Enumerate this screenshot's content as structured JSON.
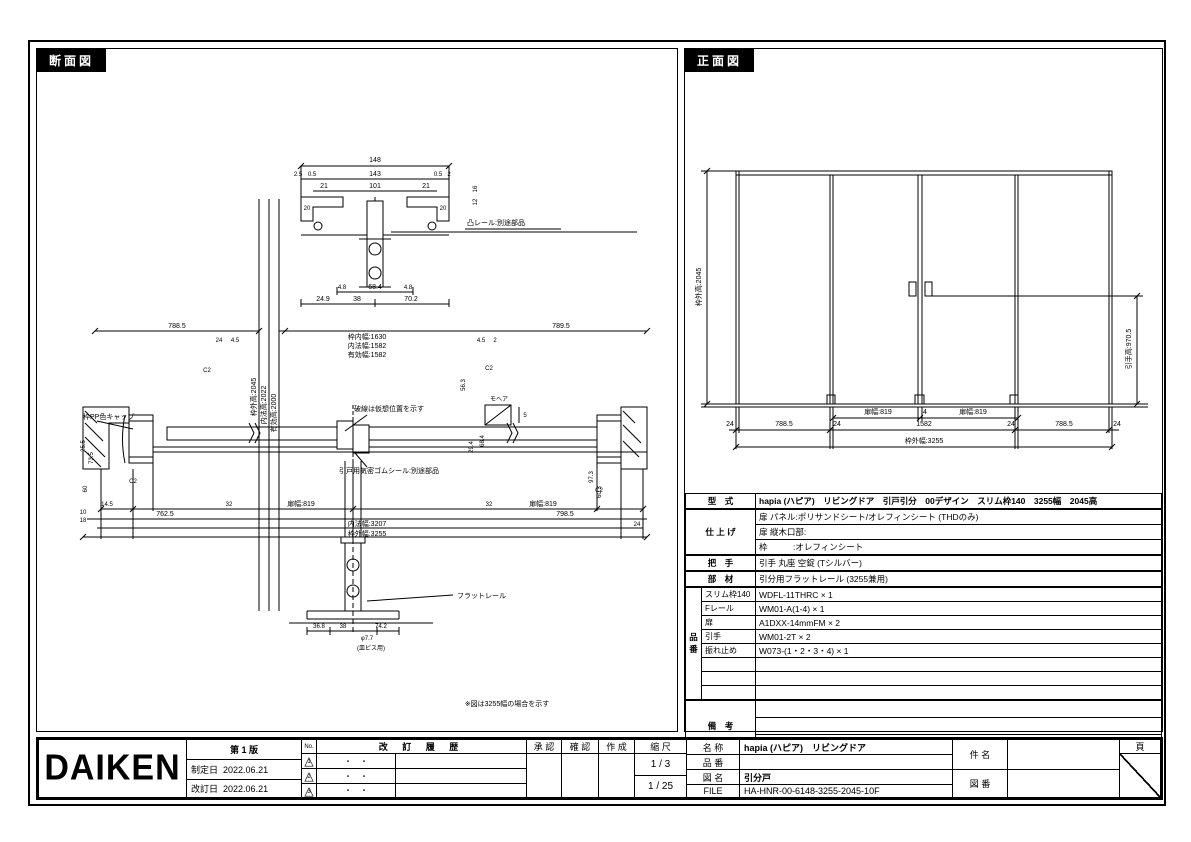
{
  "sheet": {
    "section_title": "断面図",
    "front_title": "正面図"
  },
  "section_view": {
    "texts": [
      {
        "t": "148",
        "x": 338,
        "y": 113
      },
      {
        "t": "2.5",
        "x": 261,
        "y": 127,
        "s": 6
      },
      {
        "t": "0.5",
        "x": 275,
        "y": 127,
        "s": 6
      },
      {
        "t": "143",
        "x": 338,
        "y": 127
      },
      {
        "t": "0.5",
        "x": 401,
        "y": 127,
        "s": 6
      },
      {
        "t": "2",
        "x": 412,
        "y": 127,
        "s": 6
      },
      {
        "t": "21",
        "x": 287,
        "y": 139
      },
      {
        "t": "101",
        "x": 338,
        "y": 139
      },
      {
        "t": "21",
        "x": 389,
        "y": 139
      },
      {
        "t": "20",
        "x": 270,
        "y": 161,
        "s": 6
      },
      {
        "t": "20",
        "x": 406,
        "y": 161,
        "s": 6
      },
      {
        "t": "16",
        "x": 440,
        "y": 140,
        "r": -90,
        "s": 6
      },
      {
        "t": "12",
        "x": 440,
        "y": 153,
        "r": -90,
        "s": 6
      },
      {
        "t": "凸レール:別途部品",
        "x": 430,
        "y": 176,
        "a": "start"
      },
      {
        "t": "4.8",
        "x": 305,
        "y": 240,
        "s": 6
      },
      {
        "t": "68.4",
        "x": 338,
        "y": 240
      },
      {
        "t": "4.8",
        "x": 371,
        "y": 240,
        "s": 6
      },
      {
        "t": "24.9",
        "x": 286,
        "y": 252
      },
      {
        "t": "38",
        "x": 320,
        "y": 252
      },
      {
        "t": "70.2",
        "x": 374,
        "y": 252
      },
      {
        "t": "788.5",
        "x": 140,
        "y": 279
      },
      {
        "t": "789.5",
        "x": 524,
        "y": 279
      },
      {
        "t": "24",
        "x": 182,
        "y": 293,
        "s": 6
      },
      {
        "t": "4.5",
        "x": 198,
        "y": 293,
        "s": 6
      },
      {
        "t": "4.5",
        "x": 444,
        "y": 293,
        "s": 6
      },
      {
        "t": "2",
        "x": 458,
        "y": 293,
        "s": 6
      },
      {
        "t": "枠内幅:1630",
        "x": 330,
        "y": 290
      },
      {
        "t": "内法幅:1582",
        "x": 330,
        "y": 299
      },
      {
        "t": "有効幅:1582",
        "x": 330,
        "y": 308
      },
      {
        "t": "枠外高:2045",
        "x": 219,
        "y": 348,
        "r": -90
      },
      {
        "t": "内法高:2022",
        "x": 229,
        "y": 356,
        "r": -90
      },
      {
        "t": "有効高:2000",
        "x": 239,
        "y": 364,
        "r": -90
      },
      {
        "t": "C2",
        "x": 170,
        "y": 323,
        "s": 6
      },
      {
        "t": "C2",
        "x": 452,
        "y": 321,
        "s": 6
      },
      {
        "t": "C2",
        "x": 96,
        "y": 434,
        "s": 6
      },
      {
        "t": "C2",
        "x": 562,
        "y": 443,
        "s": 6
      },
      {
        "t": "枠PP色キャップ",
        "x": 46,
        "y": 370,
        "a": "start"
      },
      {
        "t": "破線は仮想位置を示す",
        "x": 352,
        "y": 362
      },
      {
        "t": "引戸用気密ゴムシール:別途部品",
        "x": 352,
        "y": 424
      },
      {
        "t": "モヘア",
        "x": 462,
        "y": 352,
        "s": 6
      },
      {
        "t": "5",
        "x": 488,
        "y": 368,
        "s": 6
      },
      {
        "t": "56.3",
        "x": 428,
        "y": 336,
        "r": -90,
        "s": 6
      },
      {
        "t": "29.4",
        "x": 436,
        "y": 398,
        "r": -90,
        "s": 6
      },
      {
        "t": "68.4",
        "x": 447,
        "y": 392,
        "r": -90,
        "s": 6
      },
      {
        "t": "97.3",
        "x": 556,
        "y": 428,
        "r": -90,
        "s": 6
      },
      {
        "t": "60.3",
        "x": 564,
        "y": 443,
        "r": -90,
        "s": 6
      },
      {
        "t": "25.5",
        "x": 48,
        "y": 397,
        "r": -90,
        "s": 6
      },
      {
        "t": "73.5",
        "x": 56,
        "y": 409,
        "r": -90,
        "s": 6
      },
      {
        "t": "60",
        "x": 50,
        "y": 440,
        "r": -90,
        "s": 6
      },
      {
        "t": "14.5",
        "x": 70,
        "y": 457,
        "s": 6
      },
      {
        "t": "32",
        "x": 192,
        "y": 457,
        "s": 6
      },
      {
        "t": "扉幅:819",
        "x": 264,
        "y": 457
      },
      {
        "t": "32",
        "x": 452,
        "y": 457,
        "s": 6
      },
      {
        "t": "扉幅:819",
        "x": 506,
        "y": 457
      },
      {
        "t": "10",
        "x": 46,
        "y": 465,
        "s": 6
      },
      {
        "t": "18",
        "x": 46,
        "y": 473,
        "s": 6
      },
      {
        "t": "762.5",
        "x": 128,
        "y": 467
      },
      {
        "t": "798.5",
        "x": 528,
        "y": 467
      },
      {
        "t": "内法幅:3207",
        "x": 330,
        "y": 477
      },
      {
        "t": "24",
        "x": 600,
        "y": 477,
        "s": 6
      },
      {
        "t": "枠外幅:3255",
        "x": 330,
        "y": 487
      },
      {
        "t": "36.8",
        "x": 282,
        "y": 579,
        "s": 6
      },
      {
        "t": "38",
        "x": 306,
        "y": 579,
        "s": 6
      },
      {
        "t": "74.2",
        "x": 344,
        "y": 579,
        "s": 6
      },
      {
        "t": "φ7.7",
        "x": 330,
        "y": 591,
        "s": 6
      },
      {
        "t": "(皿ビス用)",
        "x": 334,
        "y": 601,
        "s": 6
      },
      {
        "t": "フラットレール",
        "x": 420,
        "y": 549,
        "a": "start"
      },
      {
        "t": "※図は3255幅の場合を示す",
        "x": 470,
        "y": 657
      }
    ]
  },
  "front_view": {
    "texts": [
      {
        "t": "枠外高:2045",
        "x": 16,
        "y": 238,
        "r": -90
      },
      {
        "t": "引手高:970.5",
        "x": 446,
        "y": 300,
        "r": -90
      },
      {
        "t": "扉幅:819",
        "x": 193,
        "y": 365
      },
      {
        "t": "4",
        "x": 240,
        "y": 365
      },
      {
        "t": "扉幅:819",
        "x": 288,
        "y": 365
      },
      {
        "t": "24",
        "x": 45,
        "y": 377
      },
      {
        "t": "788.5",
        "x": 99,
        "y": 377
      },
      {
        "t": "24",
        "x": 152,
        "y": 377
      },
      {
        "t": "1582",
        "x": 239,
        "y": 377
      },
      {
        "t": "24",
        "x": 326,
        "y": 377
      },
      {
        "t": "788.5",
        "x": 379,
        "y": 377
      },
      {
        "t": "24",
        "x": 432,
        "y": 377
      },
      {
        "t": "枠外幅:3255",
        "x": 239,
        "y": 394
      }
    ]
  },
  "spec": {
    "model_label": "型　式",
    "model_value": "hapia (ハピア)　リビングドア　引戸引分　00デザイン　スリム枠140　3255幅　2045高",
    "finish_label": "仕 上 げ",
    "finish_rows": [
      "扉 パネル:ポリサンドシート/オレフィンシート (THDのみ)",
      "扉 縦木口部:",
      "枠　　　:オレフィンシート"
    ],
    "handle_label": "把　手",
    "handle_value": "引手 丸座 空錠 (Tシルバー)",
    "parts_label": "部　材",
    "parts_value": "引分用フラットレール (3255兼用)",
    "hinban_label": "品番",
    "hinban_rows": [
      {
        "name": "スリム枠140",
        "value": "WDFL-11THRC × 1"
      },
      {
        "name": "Fレール",
        "value": "WM01-A(1-4) × 1"
      },
      {
        "name": "扉",
        "value": "A1DXX-14mmFM × 2"
      },
      {
        "name": "引手",
        "value": "WM01-2T × 2"
      },
      {
        "name": "振れ止め",
        "value": "W073-(1・2・3・4) × 1"
      },
      {
        "name": "",
        "value": ""
      },
      {
        "name": "",
        "value": ""
      },
      {
        "name": "",
        "value": ""
      }
    ],
    "remarks_label": "備　考"
  },
  "title_block": {
    "logo": "DAIKEN",
    "edition": "第 1 版",
    "enacted_label": "制定日",
    "enacted_date": "2022.06.21",
    "revised_label": "改訂日",
    "revised_date": "2022.06.21",
    "no_label": "No.",
    "rev_marks": [
      "1",
      "2",
      "3"
    ],
    "history_label": "改 訂 履 歴",
    "history_placeholder": "・　・",
    "approve_label": "承 認",
    "check_label": "確 認",
    "create_label": "作 成",
    "scale_label": "縮 尺",
    "scales": [
      "1 / 3",
      "1 / 25"
    ],
    "name_label": "名 称",
    "name_value": "hapia (ハピア)　リビングドア",
    "item_label": "品 番",
    "item_value": "",
    "drawing_label": "図 名",
    "drawing_value": "引分戸",
    "file_label": "FILE",
    "file_value": "HA-HNR-00-6148-3255-2045-10F",
    "subject_label": "件 名",
    "subject_value": "",
    "number_label": "図 番",
    "number_value": "",
    "page_label": "頁"
  }
}
